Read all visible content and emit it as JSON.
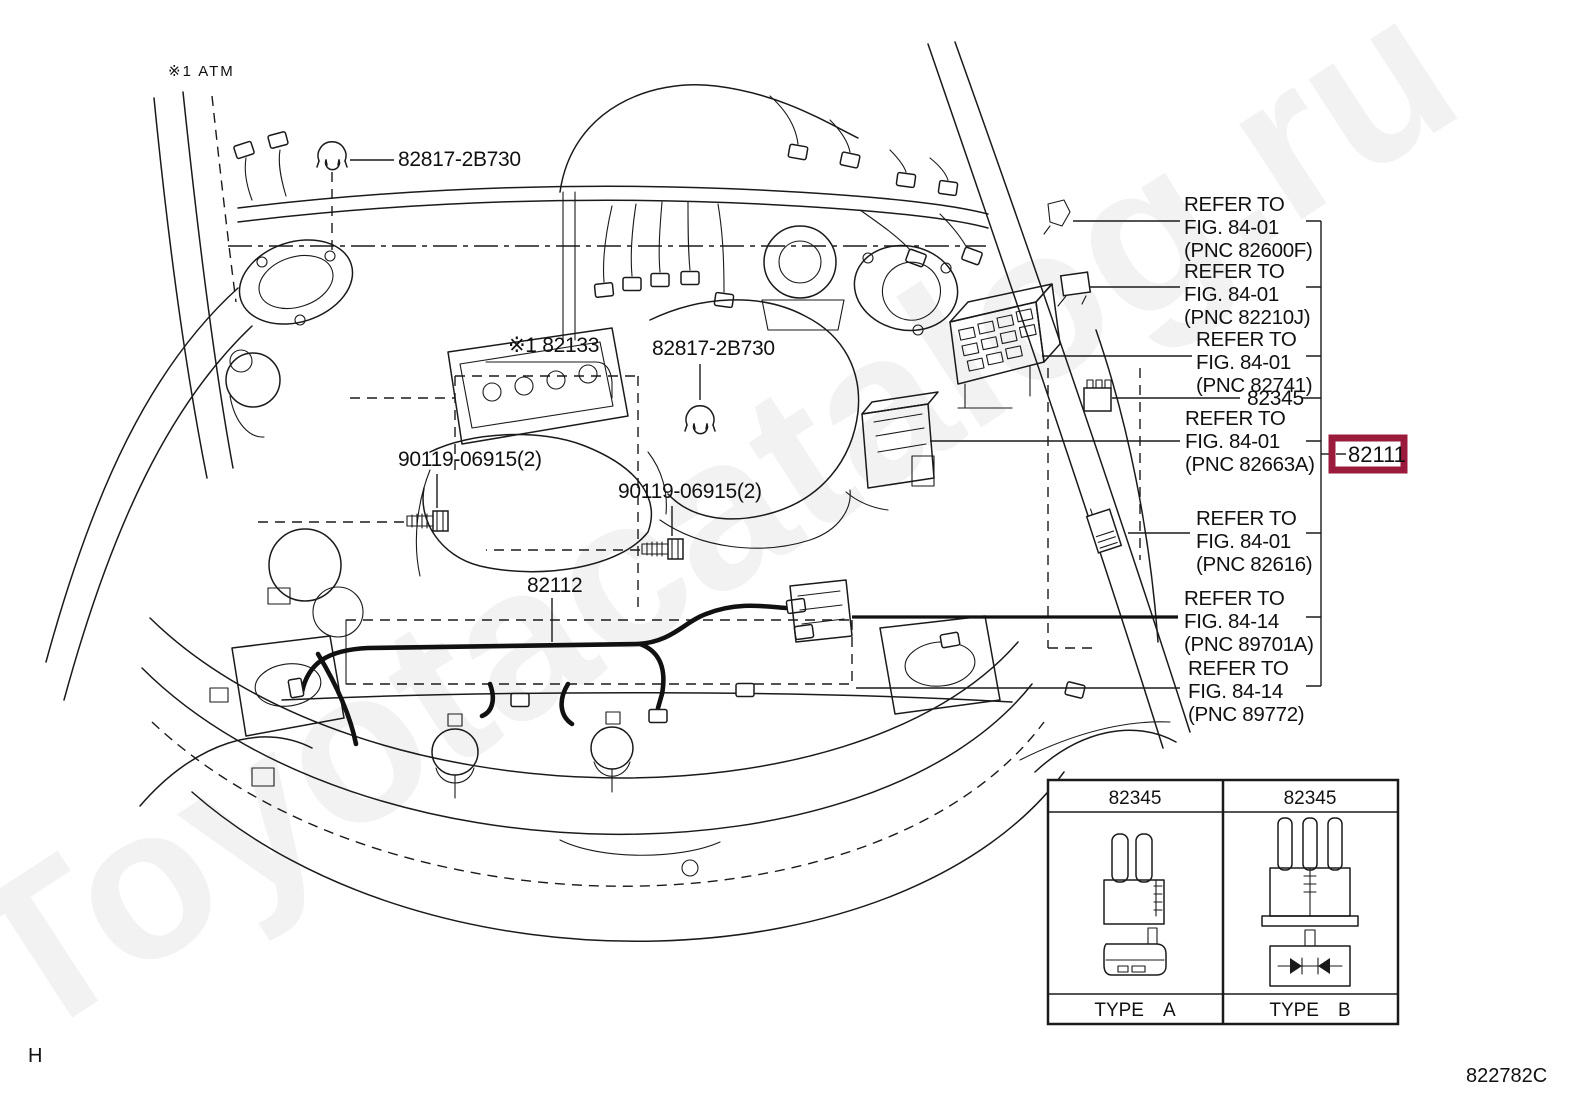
{
  "page": {
    "note": "※1 ATM",
    "sheet_letter": "H",
    "figure_code": "822782C",
    "watermark": "Toyotacatalog.ru"
  },
  "labels": {
    "clamp_top": "82817-2B730",
    "engine": "※1 82133",
    "clamp_mid": "82817-2B730",
    "bolt_left": "90119-06915(2)",
    "bolt_right": "90119-06915(2)",
    "front_harness": "82112"
  },
  "callouts": {
    "items": [
      {
        "l1": "REFER TO",
        "l2": "FIG. 84-01",
        "l3": "(PNC 82600F)"
      },
      {
        "l1": "REFER TO",
        "l2": "FIG. 84-01",
        "l3": "(PNC 82210J)"
      },
      {
        "l1": "REFER TO",
        "l2": "FIG. 84-01",
        "l3": "(PNC 82741)"
      },
      {
        "l1": "REFER TO",
        "l2": "FIG. 84-01",
        "l3": "(PNC 82663A)"
      },
      {
        "l1": "REFER TO",
        "l2": "FIG. 84-01",
        "l3": "(PNC 82616)"
      },
      {
        "l1": "REFER TO",
        "l2": "FIG. 84-14",
        "l3": "(PNC 89701A)"
      },
      {
        "l1": "REFER TO",
        "l2": "FIG. 84-14",
        "l3": "(PNC 89772)"
      }
    ],
    "part_82345": "82345"
  },
  "highlight": {
    "part_number": "82111",
    "box_color": "#9A1B3C"
  },
  "type_table": {
    "col_a": {
      "header": "82345",
      "type_label": "TYPE A"
    },
    "col_b": {
      "header": "82345",
      "type_label": "TYPE B"
    }
  }
}
